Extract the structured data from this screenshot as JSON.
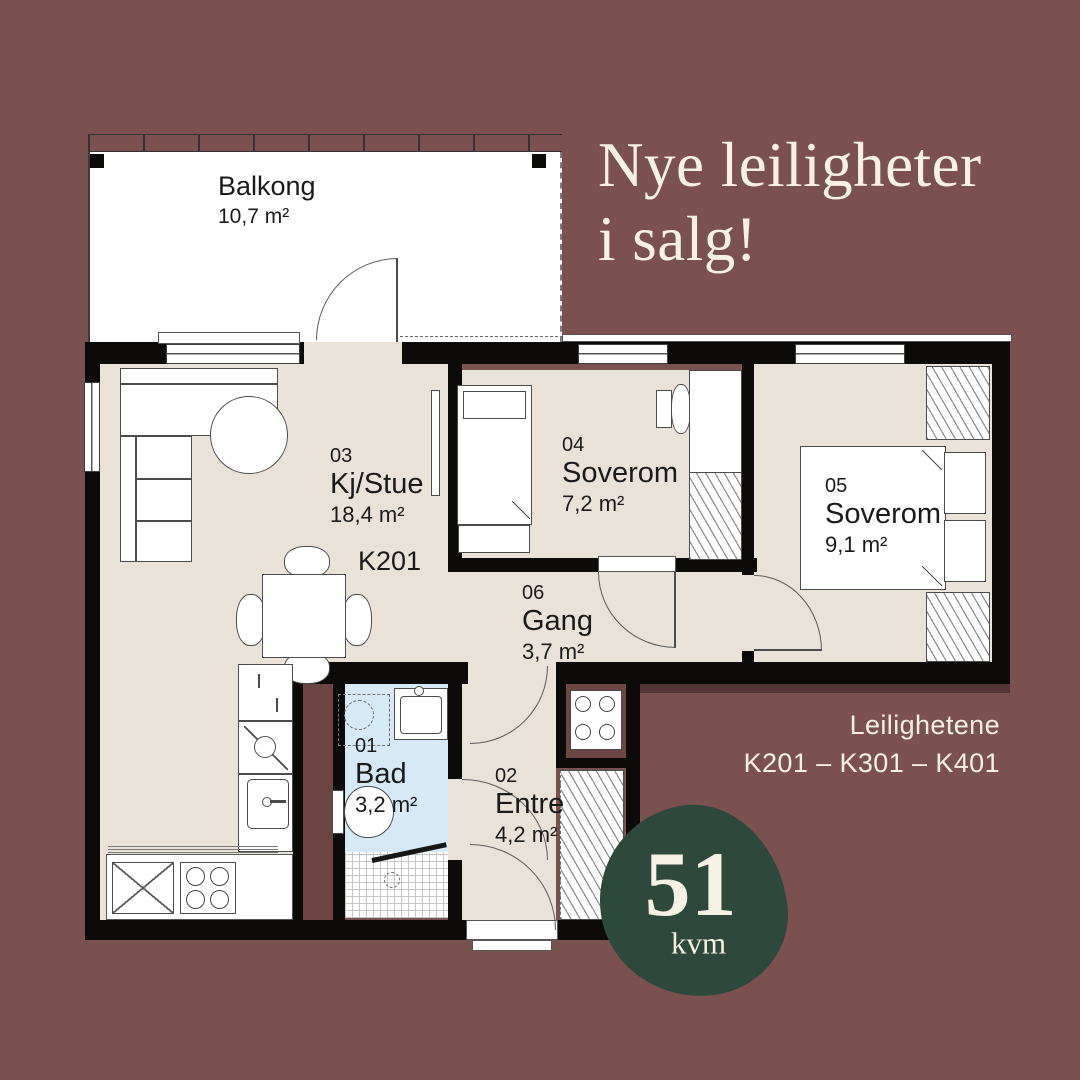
{
  "headline": {
    "line1": "Nye leiligheter",
    "line2": "i salg!"
  },
  "plan": {
    "balcony": {
      "name": "Balkong",
      "area": "10,7 m²"
    },
    "apartment_code": "K201",
    "rooms": [
      {
        "number": "03",
        "name": "Kj/Stue",
        "area": "18,4 m²"
      },
      {
        "number": "04",
        "name": "Soverom",
        "area": "7,2 m²"
      },
      {
        "number": "05",
        "name": "Soverom",
        "area": "9,1 m²"
      },
      {
        "number": "06",
        "name": "Gang",
        "area": "3,7 m²"
      },
      {
        "number": "01",
        "name": "Bad",
        "area": "3,2 m²"
      },
      {
        "number": "02",
        "name": "Entre",
        "area": "4,2 m²"
      }
    ]
  },
  "footer": {
    "line1": "Leilighetene",
    "line2": "K201 – K301 – K401"
  },
  "badge": {
    "value": "51",
    "unit": "kvm"
  },
  "colors": {
    "background": "#7B5150",
    "floor": "#E8E2D8",
    "bathroom-floor": "#D6E9F7",
    "wall": "#0C0B09",
    "furniture-line": "#4B4B4B",
    "cream": "#F6F0E5",
    "badge-green": "#2D493C",
    "shaft": "#6C4442"
  }
}
